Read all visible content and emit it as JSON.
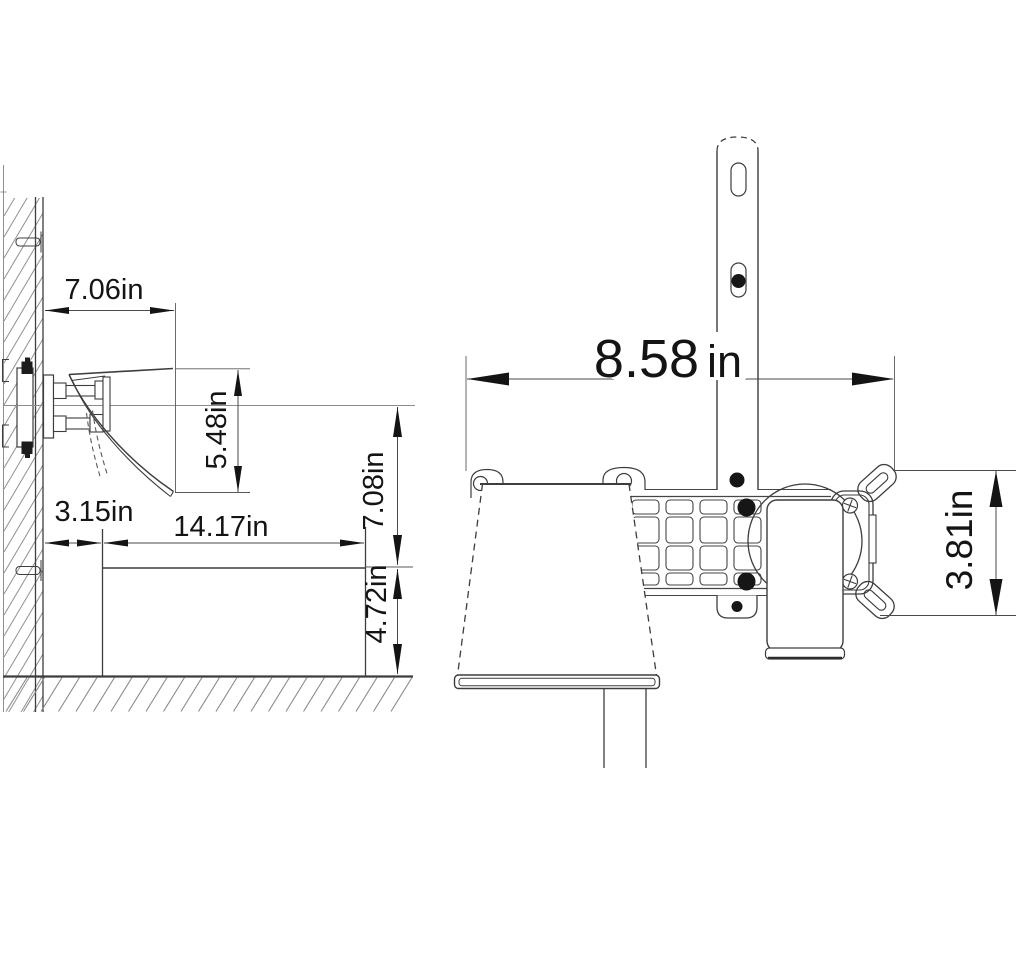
{
  "drawing": {
    "background": "#ffffff",
    "line_color": "#3d3d3d",
    "dim_color": "#4a4a4a",
    "text_color": "#141414",
    "unit": "in",
    "side_view": {
      "name": "wall-mounted waterfall faucet over basin - side elevation",
      "dims": {
        "spout_reach": {
          "label": "7.06in"
        },
        "spout_drop": {
          "label": "5.48in"
        },
        "wall_to_basin": {
          "label": "3.15in"
        },
        "basin_width": {
          "label": "14.17in"
        },
        "spout_height_above_rim": {
          "label": "7.08in"
        },
        "basin_height": {
          "label": "4.72in"
        }
      }
    },
    "front_view": {
      "name": "in-wall rough-in valve with mounting bracket - front elevation",
      "dims": {
        "overall_width": {
          "value": "8.58",
          "unit": "in"
        },
        "valve_plate_height": {
          "label": "3.81in"
        }
      }
    }
  }
}
